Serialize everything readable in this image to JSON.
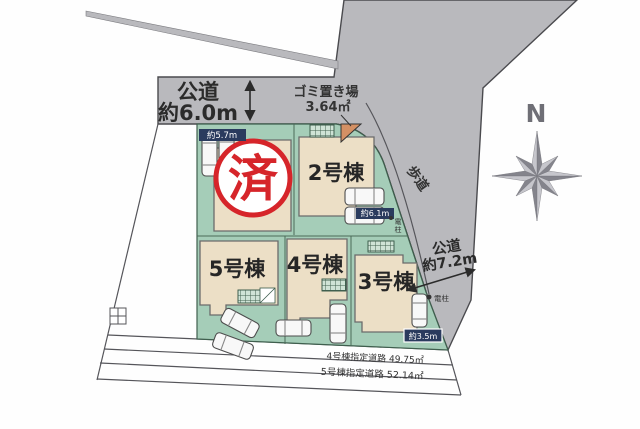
{
  "plan": {
    "title_hint": "site-plan",
    "roads": {
      "top_road_line1": "公道",
      "top_road_line2": "約6.0m",
      "right_road_line1": "公道",
      "right_road_line2": "約7.2m",
      "sidewalk_label": "歩道",
      "garbage_line1": "ゴミ置き場",
      "garbage_line2": "3.64㎡",
      "designated_road_1": "4号棟指定道路 49.75㎡",
      "designated_road_2": "5号棟指定道路 52.14㎡"
    },
    "buildings": {
      "b2": "2号棟",
      "b3": "3号棟",
      "b4": "4号棟",
      "b5": "5号棟"
    },
    "stamp": "済",
    "measurements": {
      "m57": "約5.7m",
      "m61": "約6.1m",
      "m35": "約3.5m"
    },
    "poles": {
      "p1a": "電",
      "p1b": "柱",
      "p2": "電柱"
    },
    "compass": "N",
    "colors": {
      "road_gray": "#b9b9bd",
      "lot_green": "#a5cdb8",
      "building_beige": "#ecdfc6",
      "stamp_red": "#d6252a",
      "label_navy": "#2a3b5e",
      "garbage_orange": "#d49064"
    }
  }
}
